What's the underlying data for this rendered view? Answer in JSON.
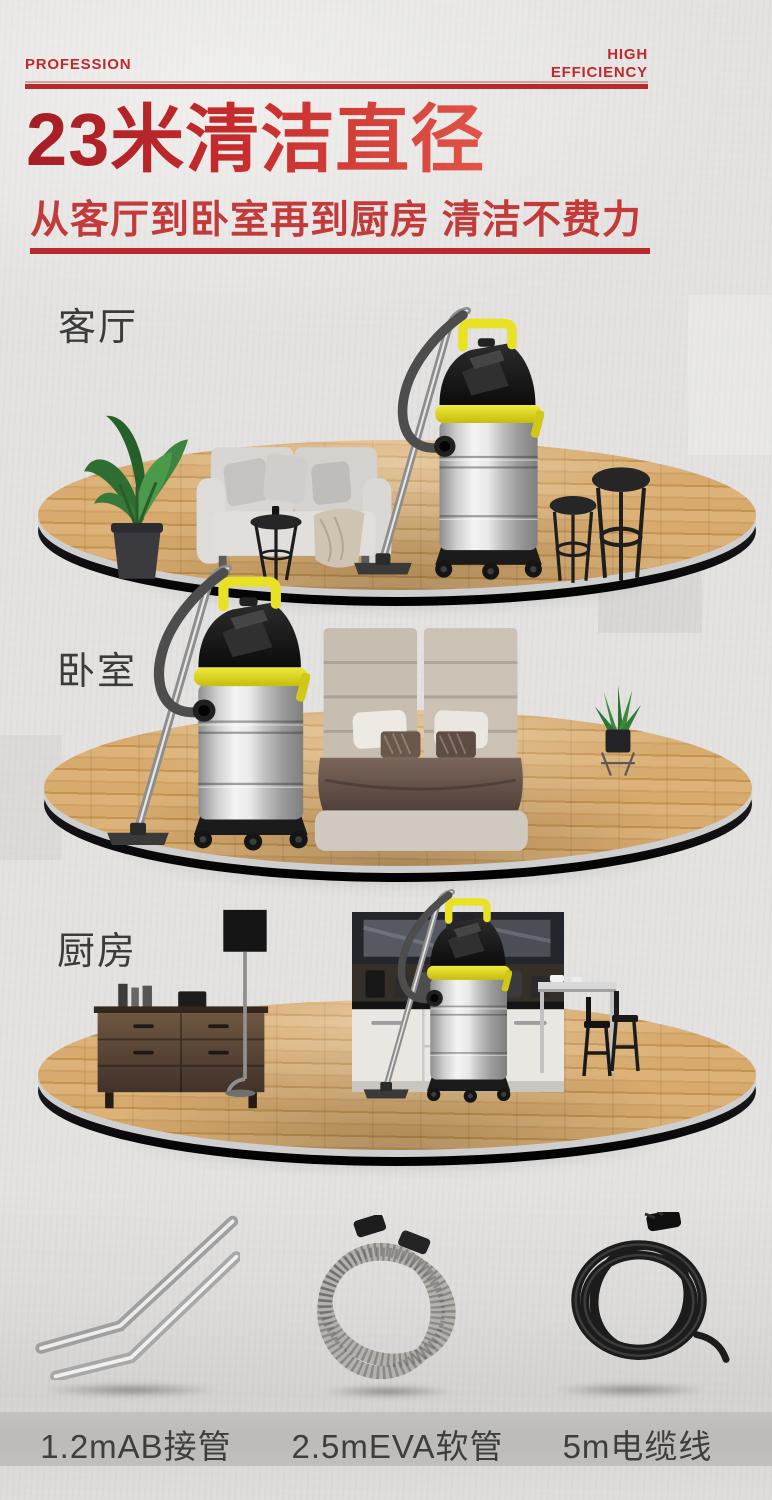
{
  "header": {
    "tag_left": "PROFESSION",
    "tag_right_line1": "HIGH",
    "tag_right_line2": "EFFICIENCY",
    "title": "23米清洁直径",
    "subtitle": "从客厅到卧室再到厨房 清洁不费力"
  },
  "scenes": [
    {
      "label": "客厅",
      "pictured_items": [
        "potted-plant",
        "sofa",
        "side-table",
        "vacuum-cleaner",
        "two-stools"
      ]
    },
    {
      "label": "卧室",
      "pictured_items": [
        "vacuum-cleaner",
        "double-bed",
        "aloe-plant-on-stand"
      ]
    },
    {
      "label": "厨房",
      "pictured_items": [
        "sideboard",
        "floor-lamp",
        "kitchen-cabinets",
        "vacuum-cleaner",
        "kitchen-island-with-bar-stools"
      ]
    }
  ],
  "accessories": [
    {
      "label": "1.2mAB接管",
      "icon": "bent-metal-tubes"
    },
    {
      "label": "2.5mEVA软管",
      "icon": "coiled-gray-hose"
    },
    {
      "label": "5m电缆线",
      "icon": "coiled-black-cable"
    }
  ],
  "colors": {
    "accent_red": "#b72a2b",
    "title_red_dark": "#a21e24",
    "title_red_light": "#e25448",
    "subtitle_red": "#c23a3a",
    "background_gray": "#e3e2e0",
    "label_band_gray": "#bcbbb9",
    "text_dark": "#3b3b3b",
    "wood_tan": "#d4a465",
    "platform_rim_dark": "#17171b",
    "vacuum_yellow": "#e8e126",
    "steel_gray": "#d9d9d9"
  }
}
